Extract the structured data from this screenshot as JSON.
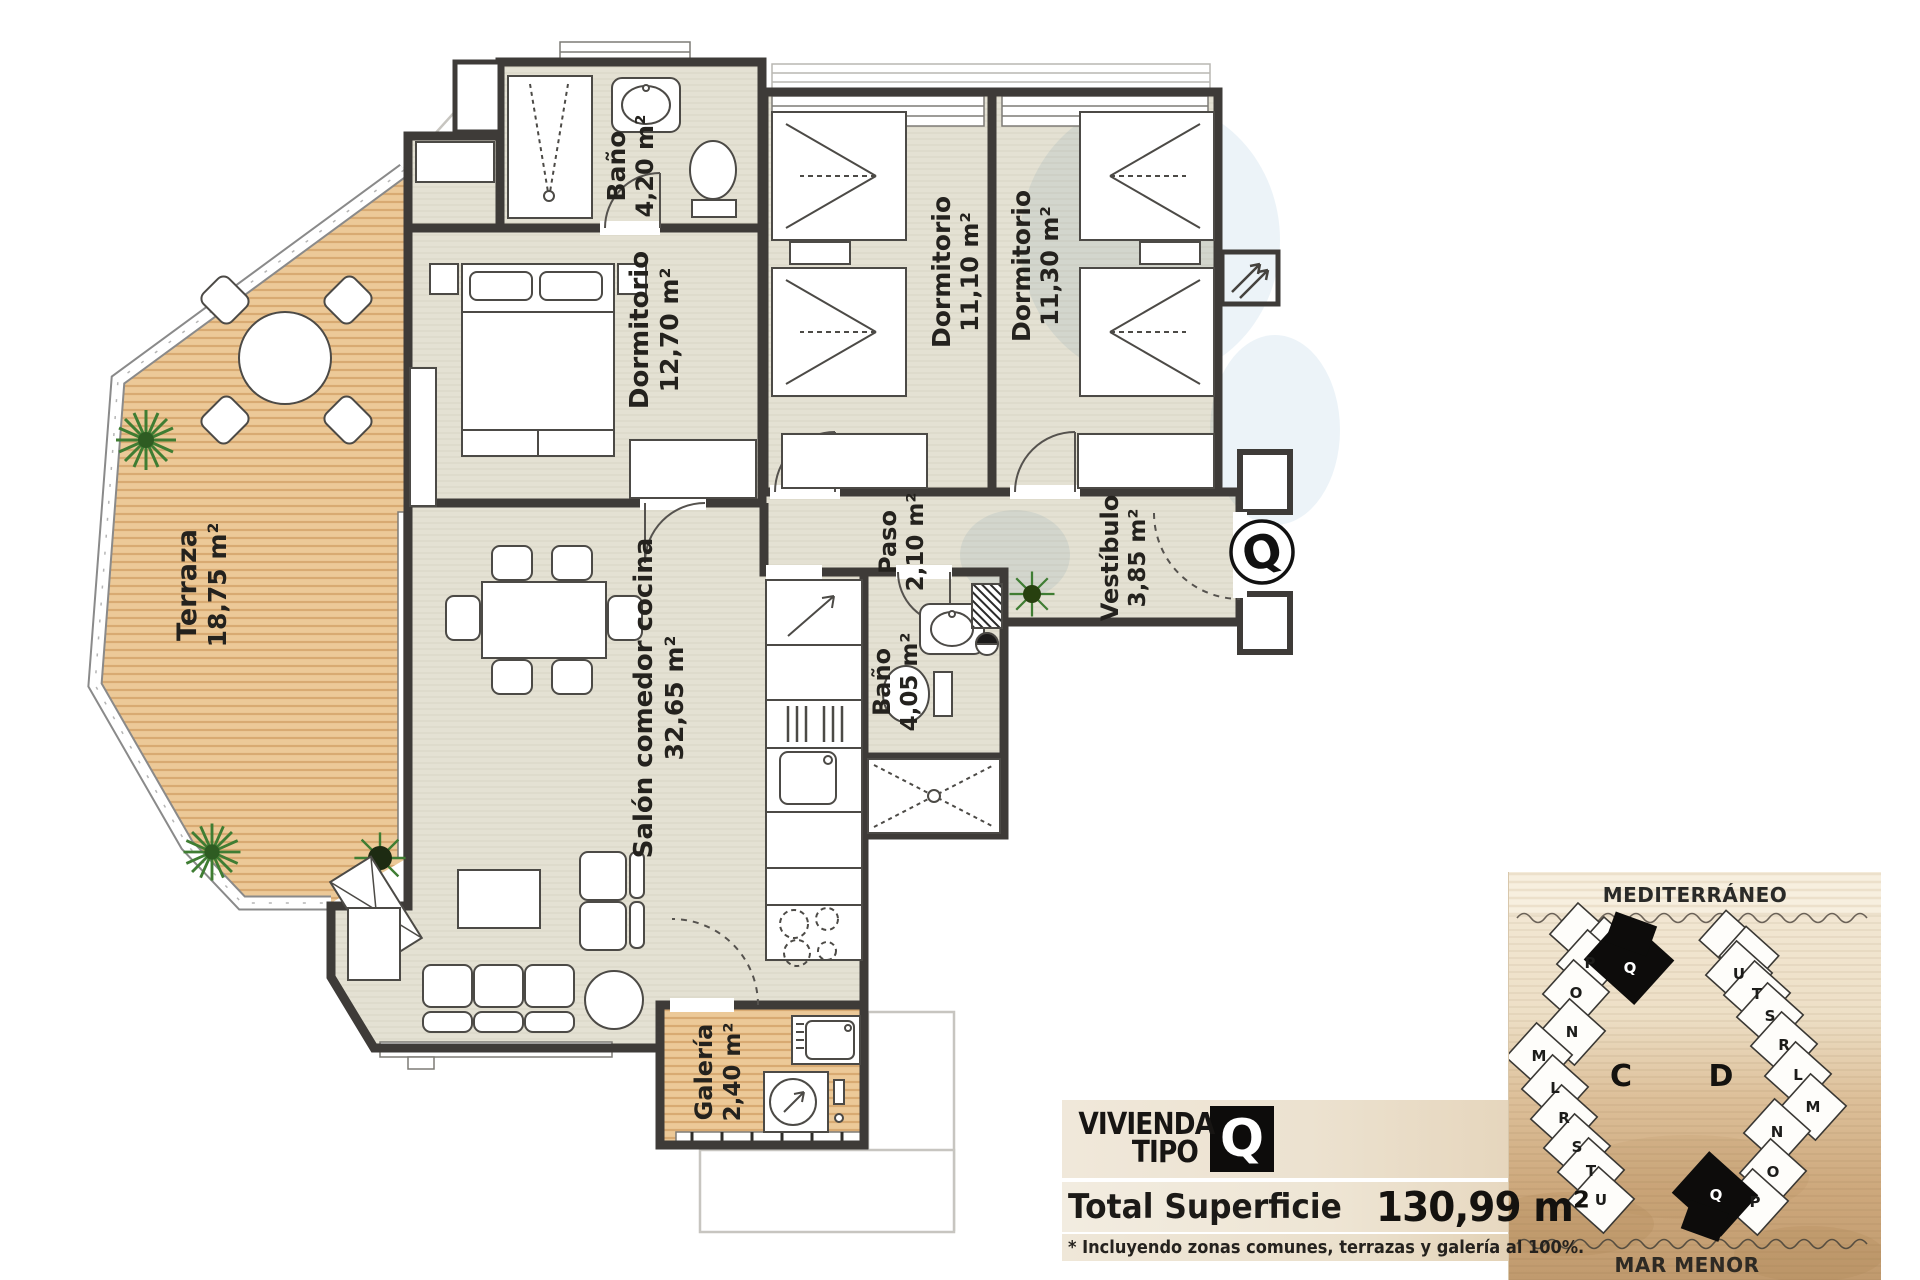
{
  "plan": {
    "rooms": [
      {
        "id": "terraza",
        "name": "Terraza",
        "area": "18,75 m²"
      },
      {
        "id": "bano_superior",
        "name": "Baño",
        "area": "4,20 m²"
      },
      {
        "id": "dormitorio_principal",
        "name": "Dormitorio",
        "area": "12,70 m²"
      },
      {
        "id": "dormitorio_2",
        "name": "Dormitorio",
        "area": "11,10 m²"
      },
      {
        "id": "dormitorio_3",
        "name": "Dormitorio",
        "area": "11,30 m²"
      },
      {
        "id": "paso",
        "name": "Paso",
        "area": "2,10 m²"
      },
      {
        "id": "vestibulo",
        "name": "Vestíbulo",
        "area": "3,85 m²"
      },
      {
        "id": "salon",
        "name": "Salón comedor cocina",
        "area": "32,65 m²"
      },
      {
        "id": "bano_inferior",
        "name": "Baño",
        "area": "4,05 m²"
      },
      {
        "id": "galeria",
        "name": "Galería",
        "area": "2,40 m²"
      }
    ],
    "unit_marker": "Q"
  },
  "title_block": {
    "line1": "VIVIENDA",
    "line2": "TIPO",
    "type_letter": "Q",
    "total_label": "Total Superficie",
    "total_value": "130,99 m²",
    "footnote": "* Incluyendo zonas comunes, terrazas y galería al 100%."
  },
  "site_map": {
    "sea_top": "MEDITERRÁNEO",
    "sea_bottom": "MAR MENOR",
    "buildings": [
      {
        "label": "C",
        "units": [
          "P",
          "Q",
          "O",
          "N",
          "M",
          "L",
          "R",
          "S",
          "T",
          "U"
        ],
        "highlighted_unit": "Q"
      },
      {
        "label": "D",
        "units": [
          "U",
          "T",
          "S",
          "R",
          "L",
          "M",
          "N",
          "O",
          "P",
          "Q"
        ],
        "highlighted_unit": "Q"
      }
    ]
  },
  "colors": {
    "floor": "#e4e1d3",
    "deck": "#ecc998",
    "wall": "#3e3b38",
    "highlight_black": "#0d0c0b",
    "sand": "#cda87c",
    "plant": "#4f8a35"
  }
}
